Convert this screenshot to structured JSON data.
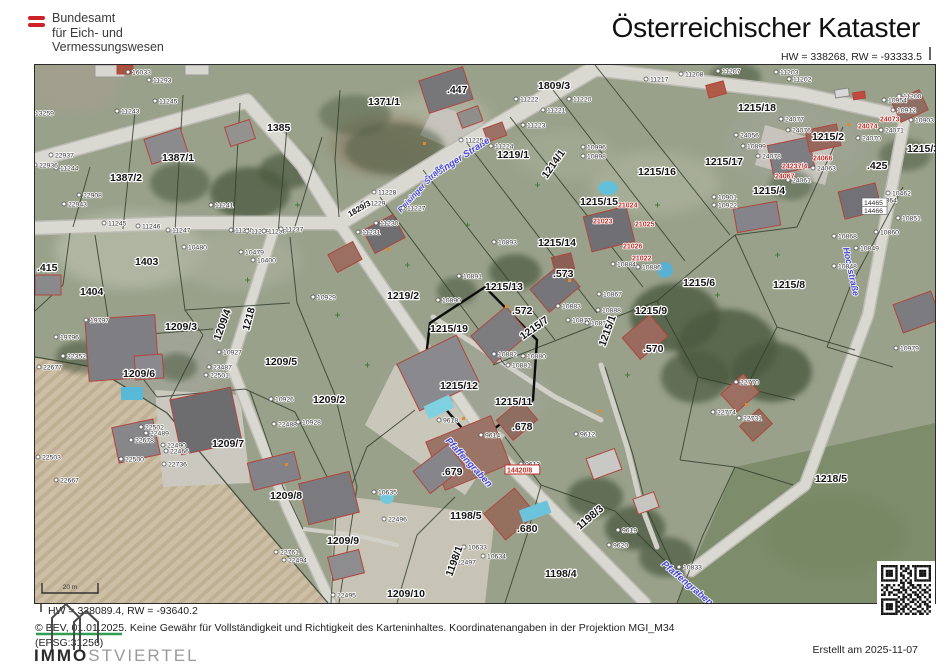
{
  "header": {
    "agency": [
      "Bundesamt",
      "für Eich- und",
      "Vermessungswesen"
    ],
    "title": "Österreichischer Kataster",
    "coord_top_right": "HW = 338268, RW = -93333.5"
  },
  "footer": {
    "coord_bottom_left": "HW = 338089.4, RW = -93640.2",
    "copyright_line": "© BEV, 01.01.2025. Keine Gewähr für Vollständigkeit und Richtigkeit des Karteninhaltes. Koordinatenangaben in der Projektion  MGI_M34",
    "epsg_line": "(EPSG:31256)",
    "created": "Erstellt am 2025-11-07",
    "logo_bold": "IMMO",
    "logo_light": "STVIERTEL"
  },
  "map": {
    "scale_bar_label": "20 m",
    "colors": {
      "flag_red": "#cc2229",
      "street_blue": "#4646d8",
      "label_red": "#c03028",
      "boundary": "#33402e",
      "road": "#d9d8d1",
      "field_tan": "#cdbfa6",
      "qr_black": "#141414"
    },
    "label_format": "[text, x, y, rotation_deg(optional), font_size(optional)]",
    "parcel_labels": [
      [
        "1371/1",
        333,
        32
      ],
      [
        ".447",
        412,
        20
      ],
      [
        "1385",
        232,
        58
      ],
      [
        "1387/1",
        127,
        88
      ],
      [
        "1387/2",
        75,
        108
      ],
      [
        "1403",
        100,
        192
      ],
      [
        ".415",
        2,
        198
      ],
      [
        "1404",
        45,
        222
      ],
      [
        "1809/3",
        503,
        16
      ],
      [
        "1219/1",
        462,
        85
      ],
      [
        "1219/2",
        352,
        226
      ],
      [
        "1218",
        214,
        258,
        -75
      ],
      [
        "1209/3",
        130,
        257
      ],
      [
        "1209/4",
        185,
        268,
        -70
      ],
      [
        "1209/5",
        230,
        292
      ],
      [
        "1209/6",
        88,
        304
      ],
      [
        "1209/2",
        278,
        330
      ],
      [
        "1209/7",
        177,
        374
      ],
      [
        "1209/8",
        235,
        426
      ],
      [
        "1209/9",
        292,
        471
      ],
      [
        "1209/10",
        352,
        524
      ],
      [
        "1198/5",
        415,
        446
      ],
      [
        "1198/4",
        510,
        504
      ],
      [
        "1198/3",
        545,
        457,
        -40
      ],
      [
        "1198/1",
        417,
        504,
        -70
      ],
      [
        "1218/5",
        780,
        409
      ],
      [
        ".679",
        407,
        402
      ],
      [
        ".680",
        482,
        459
      ],
      [
        ".678",
        477,
        357
      ],
      [
        "1215/11",
        460,
        332
      ],
      [
        "1215/12",
        405,
        316
      ],
      [
        "1215/19",
        395,
        259
      ],
      [
        "1215/13",
        450,
        217
      ],
      [
        ".572",
        477,
        241
      ],
      [
        ".573",
        518,
        204
      ],
      [
        "1215/14",
        503,
        173
      ],
      [
        "1215/15",
        545,
        132
      ],
      [
        "1215/16",
        603,
        102
      ],
      [
        "1215/17",
        670,
        92
      ],
      [
        "1215/18",
        703,
        38
      ],
      [
        "1215/2",
        777,
        67
      ],
      [
        "1215/4",
        718,
        121
      ],
      [
        ".425",
        832,
        96
      ],
      [
        "1215/3",
        872,
        79
      ],
      [
        "1215/7",
        488,
        267,
        -35
      ],
      [
        "1215/1",
        570,
        274,
        -70
      ],
      [
        "1215/9",
        600,
        241
      ],
      [
        "1215/8",
        738,
        215
      ],
      [
        "1215/6",
        648,
        213
      ],
      [
        ".570",
        608,
        279
      ],
      [
        "1214/1",
        512,
        106,
        -55
      ],
      [
        "1829/3",
        315,
        144,
        -30,
        8
      ]
    ],
    "point_labels": [
      [
        "11243",
        86,
        43
      ],
      [
        "11245",
        124,
        33
      ],
      [
        "11244",
        25,
        100
      ],
      [
        "13259",
        0,
        45
      ],
      [
        "16033",
        97,
        4
      ],
      [
        "11293",
        118,
        12
      ],
      [
        "22937",
        20,
        87
      ],
      [
        "22936",
        4,
        97
      ],
      [
        "22908",
        48,
        127
      ],
      [
        "22943",
        33,
        136
      ],
      [
        "11245",
        73,
        155
      ],
      [
        "11246",
        107,
        158
      ],
      [
        "11247",
        137,
        162
      ],
      [
        "11241",
        180,
        137
      ],
      [
        "11240",
        200,
        162
      ],
      [
        "11239",
        216,
        163
      ],
      [
        "11238",
        233,
        163
      ],
      [
        "11237",
        250,
        161
      ],
      [
        "10480",
        153,
        179
      ],
      [
        "10479",
        210,
        184
      ],
      [
        "10400",
        222,
        192
      ],
      [
        "11229",
        332,
        135
      ],
      [
        "11228",
        343,
        124
      ],
      [
        "11227",
        372,
        140
      ],
      [
        "11230",
        345,
        155
      ],
      [
        "11231",
        327,
        164
      ],
      [
        "11225",
        430,
        72
      ],
      [
        "11224",
        460,
        78
      ],
      [
        "11222",
        485,
        31
      ],
      [
        "11221",
        512,
        42
      ],
      [
        "11223",
        492,
        57
      ],
      [
        "11220",
        538,
        31
      ],
      [
        "10996",
        552,
        79
      ],
      [
        "10898",
        552,
        88
      ],
      [
        "10893",
        463,
        174
      ],
      [
        "10891",
        428,
        208
      ],
      [
        "10890",
        407,
        232
      ],
      [
        "10883",
        527,
        238
      ],
      [
        "10888",
        567,
        242
      ],
      [
        "10877",
        537,
        252
      ],
      [
        "10878",
        556,
        255
      ],
      [
        "10867",
        568,
        226
      ],
      [
        "10884",
        582,
        196
      ],
      [
        "10886",
        607,
        199
      ],
      [
        "10882",
        463,
        286
      ],
      [
        "10880",
        492,
        288
      ],
      [
        "10881",
        477,
        297
      ],
      [
        "11217",
        615,
        11
      ],
      [
        "11208",
        650,
        6
      ],
      [
        "11207",
        687,
        3
      ],
      [
        "11203",
        745,
        4
      ],
      [
        "11202",
        758,
        11
      ],
      [
        "11200",
        868,
        28
      ],
      [
        "10912",
        862,
        42
      ],
      [
        "10903",
        880,
        52
      ],
      [
        "24077",
        750,
        51
      ],
      [
        "24076",
        757,
        62
      ],
      [
        "24056",
        705,
        67
      ],
      [
        "10899",
        712,
        78
      ],
      [
        "24078",
        727,
        88
      ],
      [
        "24061",
        757,
        112
      ],
      [
        "24063",
        782,
        100
      ],
      [
        "24071",
        850,
        62
      ],
      [
        "24070",
        827,
        70
      ],
      [
        "10901",
        683,
        129
      ],
      [
        "10922",
        683,
        137
      ],
      [
        "10954",
        853,
        32
      ],
      [
        "10462",
        857,
        125
      ],
      [
        "10864",
        843,
        132
      ],
      [
        "10851",
        867,
        150
      ],
      [
        "10860",
        845,
        164
      ],
      [
        "10868",
        803,
        168
      ],
      [
        "10849",
        825,
        180
      ],
      [
        "10848",
        803,
        198
      ],
      [
        "10979",
        865,
        280
      ],
      [
        "9618",
        408,
        352
      ],
      [
        "9614",
        450,
        367
      ],
      [
        "9613",
        490,
        396
      ],
      [
        "9612",
        545,
        366
      ],
      [
        "9619",
        587,
        462
      ],
      [
        "9620",
        578,
        477
      ],
      [
        "10833",
        648,
        499
      ],
      [
        "10635",
        343,
        424
      ],
      [
        "22496",
        353,
        451
      ],
      [
        "22761",
        245,
        484
      ],
      [
        "22494",
        253,
        492
      ],
      [
        "22495",
        302,
        527
      ],
      [
        "22497",
        422,
        494
      ],
      [
        "10634",
        452,
        488
      ],
      [
        "10633",
        433,
        479
      ],
      [
        "10929",
        282,
        229
      ],
      [
        "19797",
        55,
        252
      ],
      [
        "19796",
        25,
        269
      ],
      [
        "22352",
        32,
        288
      ],
      [
        "22677",
        8,
        299
      ],
      [
        "10927",
        188,
        284
      ],
      [
        "23487",
        178,
        299
      ],
      [
        "22501",
        175,
        307
      ],
      [
        "10926",
        240,
        331
      ],
      [
        "22488",
        243,
        356
      ],
      [
        "10928",
        267,
        354
      ],
      [
        "22502",
        110,
        359
      ],
      [
        "22489",
        115,
        365
      ],
      [
        "22678",
        100,
        372
      ],
      [
        "22490",
        132,
        377
      ],
      [
        "22466",
        135,
        383
      ],
      [
        "22500",
        90,
        391
      ],
      [
        "22736",
        133,
        396
      ],
      [
        "22503",
        7,
        389
      ],
      [
        "22667",
        25,
        412
      ],
      [
        "22770",
        705,
        314
      ],
      [
        "22774",
        682,
        344
      ],
      [
        "22731",
        708,
        350
      ]
    ],
    "boxed_labels": [
      [
        "14466",
        829,
        142
      ],
      [
        "14465",
        829,
        134
      ]
    ],
    "red_labels": [
      [
        "21024",
        583,
        136
      ],
      [
        "21023",
        558,
        152
      ],
      [
        "21025",
        600,
        155
      ],
      [
        "21026",
        588,
        177
      ],
      [
        "21022",
        597,
        189
      ],
      [
        "24067",
        740,
        107
      ],
      [
        "24066",
        778,
        89
      ],
      [
        "24073",
        845,
        50
      ],
      [
        "24074",
        823,
        57
      ],
      [
        "24237/4",
        747,
        97
      ],
      [
        "14420/8",
        472,
        401,
        "box"
      ]
    ],
    "street_labels": [
      [
        "Reisinger Straße",
        392,
        110,
        -33,
        9.5
      ],
      [
        "Reisinger Straße",
        366,
        140,
        -47,
        8
      ],
      [
        "Pfaffengraben",
        410,
        368,
        47,
        9.5
      ],
      [
        "Pfaffengraben",
        626,
        492,
        40,
        9.5
      ],
      [
        "Hochstraße",
        808,
        175,
        78,
        9
      ]
    ],
    "qr_modules": [
      "111111101101011111111",
      "100000101011001000001",
      "101110100110101011101",
      "101110101001101011101",
      "101110101100101011101",
      "100000100101001000001",
      "111111101010101111111",
      "000000001101100000000",
      "101101010100110110101",
      "011010001101011010010",
      "101001110110100101101",
      "010110011010011010110",
      "110101100101101101001",
      "000000010110100110101",
      "111111101101011010010",
      "100000110100110101101",
      "101110101011001010110",
      "101110110110100110011",
      "101110101101011001010",
      "100000110100100110101",
      "111111101011011011010"
    ]
  }
}
